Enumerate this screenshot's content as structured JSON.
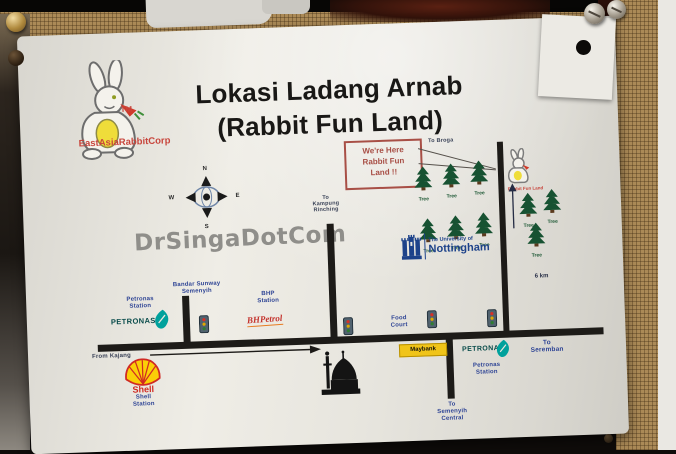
{
  "sign": {
    "title": {
      "line1": "Lokasi Ladang Arnab",
      "line2": "(Rabbit Fun Land)"
    },
    "brand": {
      "tm": "TM",
      "name": "EastAsiaRabbitCorp"
    },
    "watermark": "DrSingaDotCom",
    "here_marker": {
      "line1": "We're Here",
      "line2": "Rabbit Fun",
      "line3": "Land !!",
      "caption": "Rabbit Fun Land"
    },
    "compass": {
      "n": "N",
      "e": "E",
      "s": "S",
      "w": "W"
    },
    "tree_label": "Tree",
    "university": {
      "line1": "The University of",
      "line2": "Nottingham"
    },
    "distance": "6 km",
    "directions": {
      "to_broga": "To Broga",
      "from_kajang": "From Kajang",
      "to_seremban": {
        "line1": "To",
        "line2": "Seremban"
      },
      "to_semenyih_central": {
        "line1": "To",
        "line2": "Semenyih",
        "line3": "Central"
      },
      "to_kampung": {
        "line1": "To",
        "line2": "Kampung",
        "line3": "Rinching"
      }
    },
    "places": {
      "petronas_left": {
        "line1": "Petronas",
        "line2": "Station",
        "logo": "PETRONAS"
      },
      "bandar_sunway": {
        "line1": "Bandar Sunway",
        "line2": "Semenyih"
      },
      "bhp": {
        "line1": "BHP",
        "line2": "Station",
        "logo": "BHPetrol"
      },
      "shell": {
        "logo": "Shell",
        "line1": "Shell",
        "line2": "Station"
      },
      "food_court": {
        "line1": "Food",
        "line2": "Court"
      },
      "maybank": {
        "logo": "Maybank"
      },
      "petronas_right": {
        "logo": "PETRONAS",
        "line1": "Petronas",
        "line2": "Station"
      }
    },
    "colors": {
      "label-blue": "#2e4495",
      "marker-red": "#a84f46",
      "brand-red": "#c8453c",
      "petronas-teal": "#00a19c",
      "tree-green": "#1a5632",
      "uon-blue": "#1d428a",
      "maybank-yellow": "#f0c419",
      "shell-yellow": "#fbce07",
      "shell-red": "#d02a23",
      "road-black": "#1d1b18"
    }
  }
}
